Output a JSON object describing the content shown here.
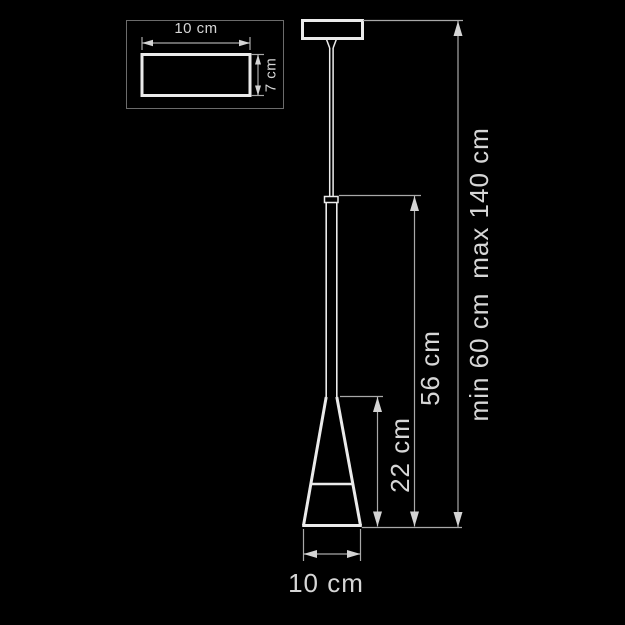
{
  "drawing": {
    "type": "pendant-lamp-dimension-diagram",
    "background_color": "#000000",
    "object_line_color": "#ebebeb",
    "dimension_line_color": "#a8a8a8",
    "text_color": "#d6d6d6"
  },
  "inset": {
    "description": "canopy top view",
    "width_label": "10 cm",
    "height_label": "7 cm"
  },
  "dimensions": {
    "shade_height_label": "22 cm",
    "fixture_height_label": "56 cm",
    "overall_min_label": "min 60 cm",
    "overall_max_label": "max 140 cm",
    "shade_diameter_label": "10 cm"
  }
}
